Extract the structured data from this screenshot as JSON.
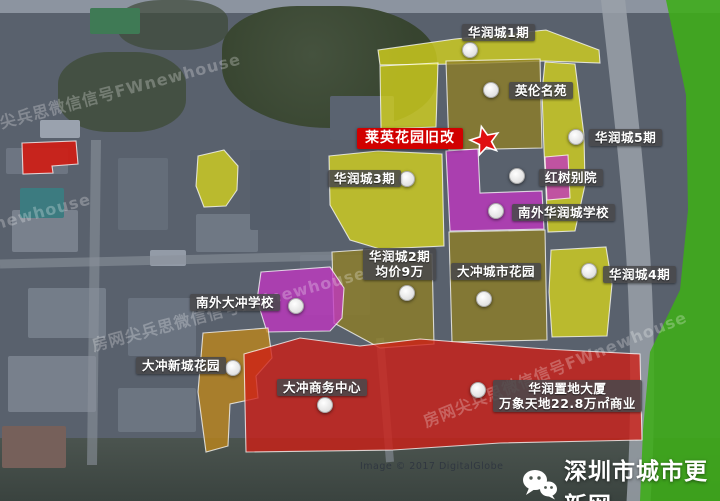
{
  "map": {
    "zone_colors": {
      "bright_yellow": "#d6d31c",
      "olive": "#8f7f25",
      "magenta": "#c136c1",
      "orange": "#bf861a",
      "red": "#cf1d15",
      "green": "#3dad18"
    },
    "highlight": {
      "label": "莱英花园旧改"
    },
    "labels": [
      {
        "name": "huarun-city-phase-1",
        "lines": [
          "华润城1期"
        ]
      },
      {
        "name": "yinglun-mingyuan",
        "lines": [
          "英伦名苑"
        ]
      },
      {
        "name": "huarun-city-phase-5",
        "lines": [
          "华润城5期"
        ]
      },
      {
        "name": "huarun-city-phase-3",
        "lines": [
          "华润城3期"
        ]
      },
      {
        "name": "hongshu-bieyuan",
        "lines": [
          "红树别院"
        ]
      },
      {
        "name": "nanwai-huarun-city-school",
        "lines": [
          "南外华润城学校"
        ]
      },
      {
        "name": "huarun-city-phase-2",
        "lines": [
          "华润城2期",
          "均价9万"
        ]
      },
      {
        "name": "dachong-city-garden",
        "lines": [
          "大冲城市花园"
        ]
      },
      {
        "name": "huarun-city-phase-4",
        "lines": [
          "华润城4期"
        ]
      },
      {
        "name": "nanwai-dachong-school",
        "lines": [
          "南外大冲学校"
        ]
      },
      {
        "name": "dachong-xincheng-garden",
        "lines": [
          "大冲新城花园"
        ]
      },
      {
        "name": "dachong-business-center",
        "lines": [
          "大冲商务中心"
        ]
      },
      {
        "name": "huarun-zhidi-tower",
        "lines": [
          "华润置地大厦",
          "万象天地22.8万㎡商业"
        ]
      }
    ],
    "watermark": "房网尖兵思微信信号FWnewhouse",
    "copyright": "Image © 2017 DigitalGlobe",
    "branding": "深圳市城市更新网"
  }
}
